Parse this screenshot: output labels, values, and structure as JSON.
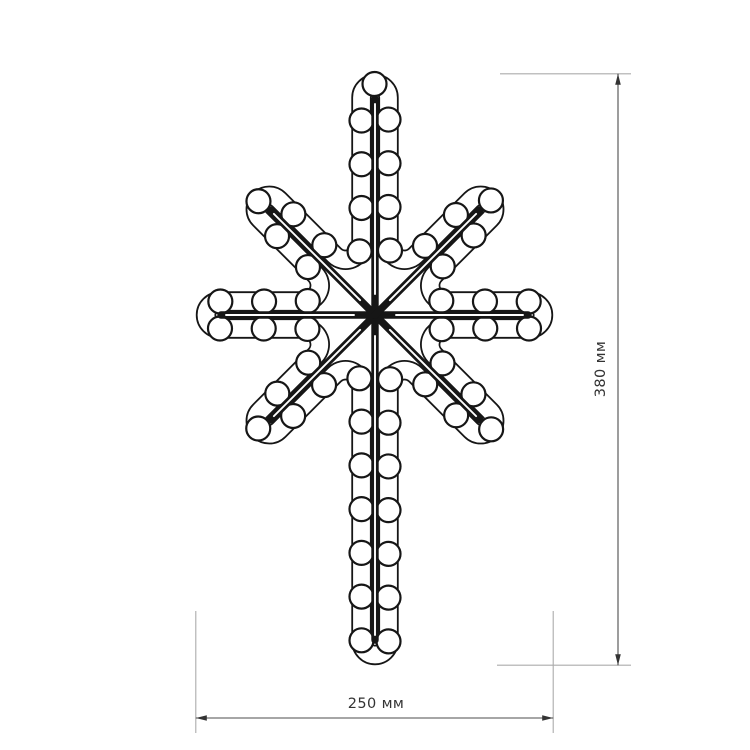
{
  "page": {
    "background": "#ffffff",
    "line_color": "#161616"
  },
  "figure": {
    "type": "led-neon-flex-star-8-rays",
    "description": "technical outline drawing of an eight-pointed LED star with bulbs along a flex tube and straight frame rods",
    "center": {
      "x": 375,
      "y": 315
    },
    "rays": [
      {
        "angle": 0,
        "length": 168
      },
      {
        "angle": 45,
        "length": 163
      },
      {
        "angle": 90,
        "length": 340
      },
      {
        "angle": 135,
        "length": 163
      },
      {
        "angle": 180,
        "length": 169
      },
      {
        "angle": 225,
        "length": 163
      },
      {
        "angle": 270,
        "length": 231
      },
      {
        "angle": 315,
        "length": 163
      }
    ],
    "tube": {
      "offset": 13.5,
      "width": 20.4,
      "inner_width": 16.8,
      "fillet_radius": 16
    },
    "bulbs": {
      "radius": 12,
      "spacing": 43.5,
      "stroke_width": 2.2
    },
    "rod": {
      "width": 7.4,
      "core_width": 1.9
    }
  },
  "dimensions": {
    "height_label": "380 мм",
    "width_label": "250 мм",
    "line_color": "#4d4d4d",
    "extension_color": "#ababab",
    "text_color": "#333333"
  }
}
